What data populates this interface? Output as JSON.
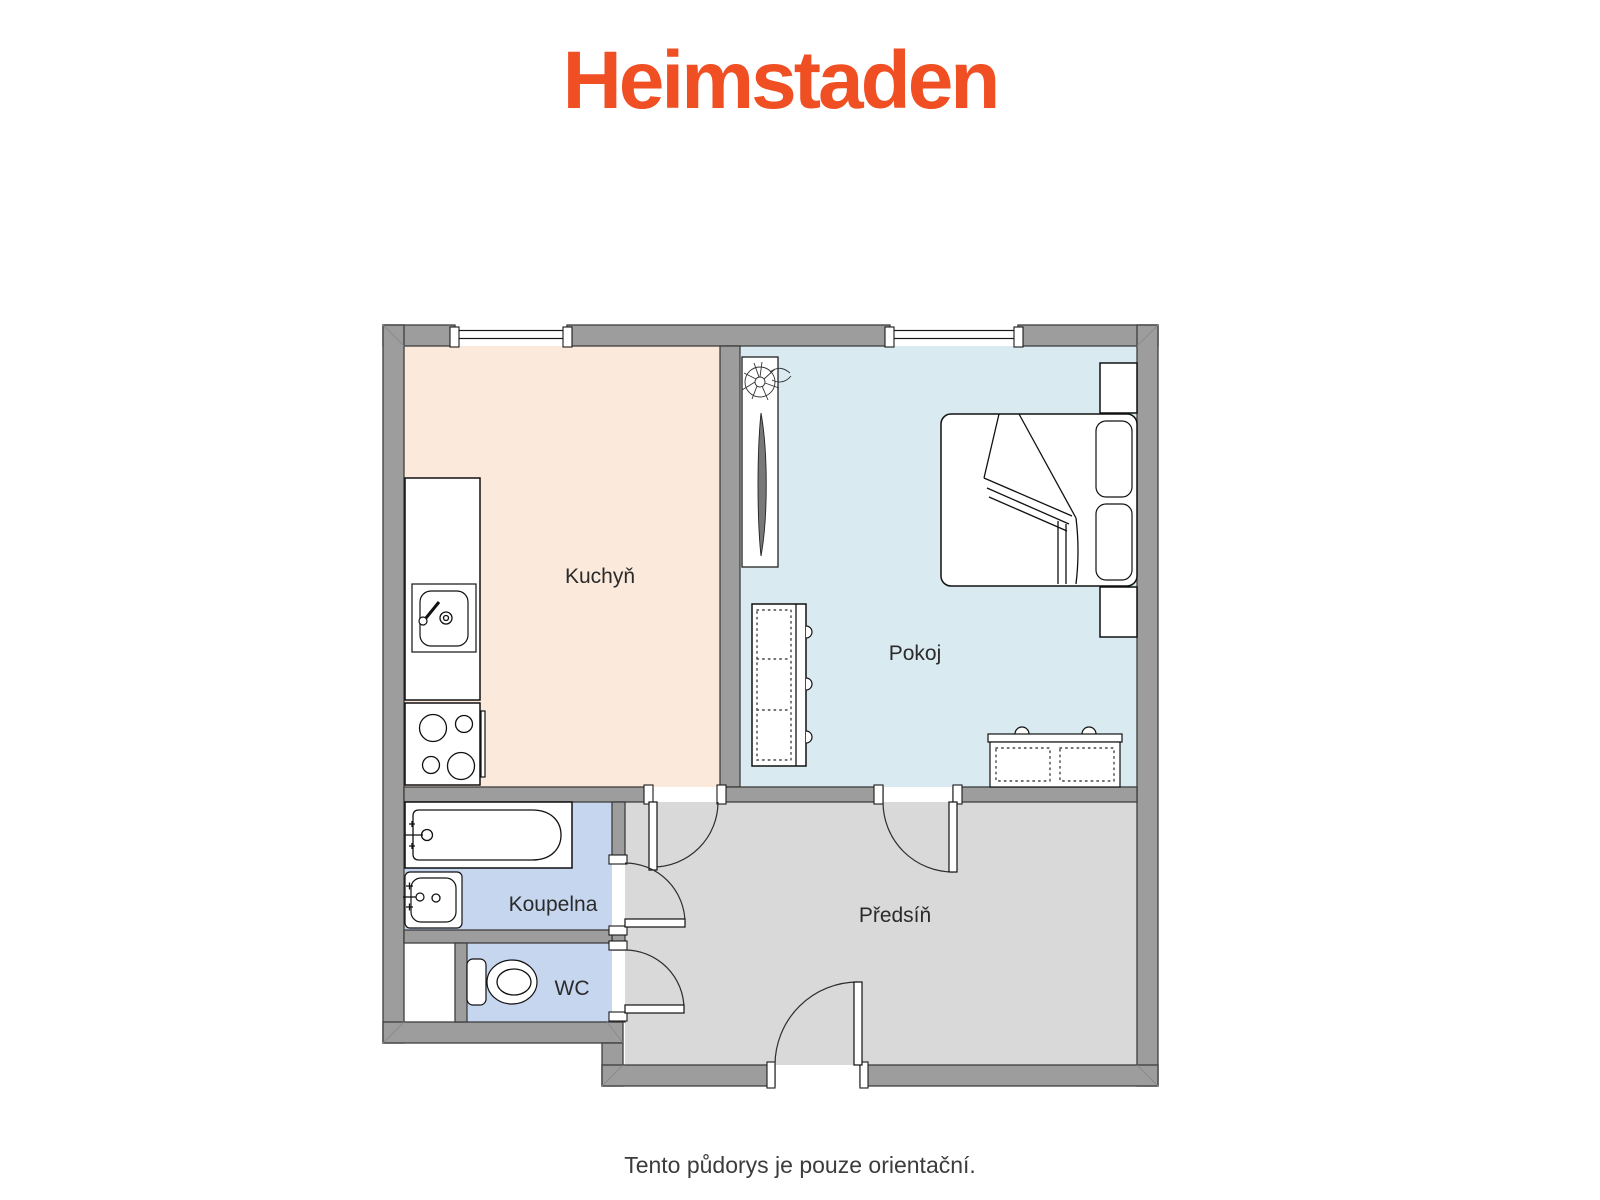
{
  "logo": {
    "text": "Heimstaden",
    "color": "#F04E23"
  },
  "plan": {
    "wall_fill": "#9D9D9D",
    "wall_stroke": "#3E3E3E",
    "label_color": "#2B2B2B"
  },
  "rooms": {
    "kitchen": {
      "label": "Kuchyň",
      "fill": "#FBE9DB"
    },
    "room": {
      "label": "Pokoj",
      "fill": "#D9EAF1"
    },
    "bathroom": {
      "label": "Koupelna",
      "fill": "#C6D6EF"
    },
    "wc": {
      "label": "WC",
      "fill": "#C6D6EF"
    },
    "hallway": {
      "label": "Předsíň",
      "fill": "#D9D9D9"
    }
  },
  "footer": {
    "disclaimer": "Tento půdorys je pouze orientační.",
    "color": "#3C3C3C"
  }
}
